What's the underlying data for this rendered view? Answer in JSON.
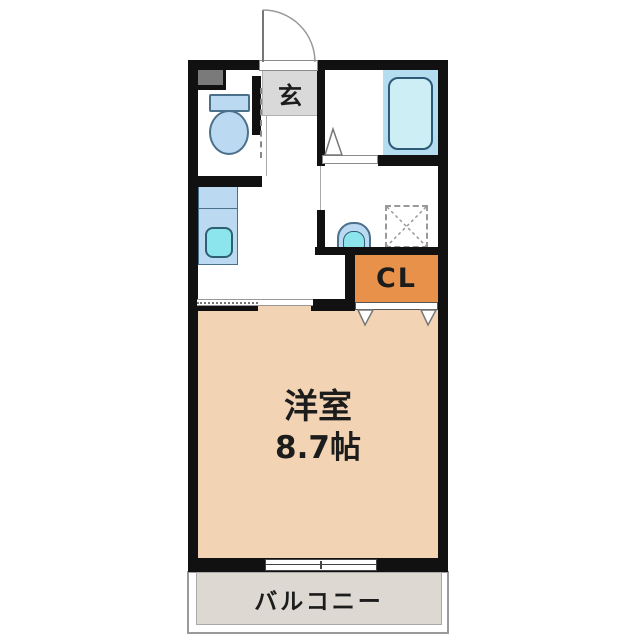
{
  "labels": {
    "entrance": "玄",
    "closet": "CL",
    "room_name": "洋室",
    "room_area": "8.7帖",
    "balcony": "バルコニー"
  },
  "colors": {
    "wall": "#111111",
    "text": "#1c1c1c",
    "room_floor": "#f2d4b5",
    "closet_fill": "#e8914a",
    "entrance_fill": "#d9d9d9",
    "balcony_fill": "#ddd8d1",
    "fixture_blue": "#bcd9f2",
    "fixture_cyan": "#8ce4ec",
    "bath_zone": "#b5ddf0",
    "bathtub_fill": "#cdeef5",
    "pipe_space": "#7a7a7a"
  }
}
